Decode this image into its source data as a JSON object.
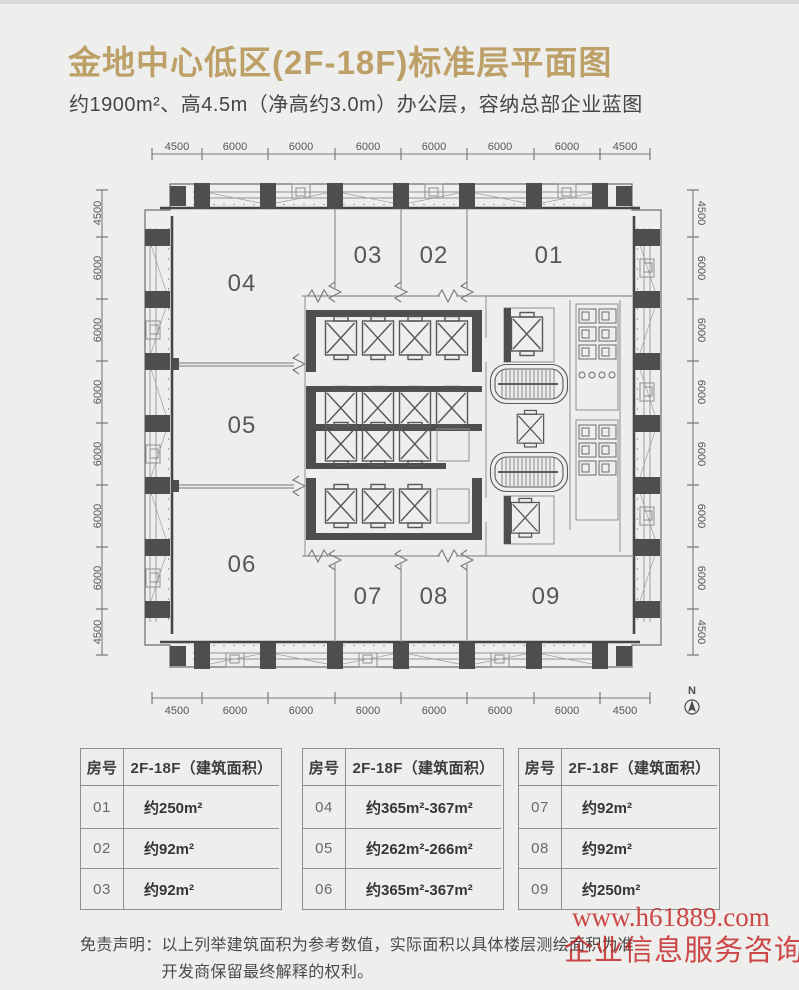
{
  "header": {
    "title": "金地中心低区(2F-18F)标准层平面图",
    "subtitle": "约1900m²、高4.5m（净高约3.0m）办公层，容纳总部企业蓝图"
  },
  "plan": {
    "dims_top": [
      "4500",
      "6000",
      "6000",
      "6000",
      "6000",
      "6000",
      "6000",
      "4500"
    ],
    "dims_bottom": [
      "4500",
      "6000",
      "6000",
      "6000",
      "6000",
      "6000",
      "6000",
      "4500"
    ],
    "dims_left": [
      "4500",
      "6000",
      "6000",
      "6000",
      "6000",
      "6000",
      "6000",
      "4500"
    ],
    "dims_right": [
      "4500",
      "6000",
      "6000",
      "6000",
      "6000",
      "6000",
      "6000",
      "4500"
    ],
    "room_labels": [
      "01",
      "02",
      "03",
      "04",
      "05",
      "06",
      "07",
      "08",
      "09"
    ],
    "north_label": "N"
  },
  "tables": [
    {
      "headers": [
        "房号",
        "2F-18F（建筑面积）"
      ],
      "rows": [
        {
          "no": "01",
          "area": "约250m²"
        },
        {
          "no": "02",
          "area": "约92m²"
        },
        {
          "no": "03",
          "area": "约92m²"
        }
      ]
    },
    {
      "headers": [
        "房号",
        "2F-18F（建筑面积）"
      ],
      "rows": [
        {
          "no": "04",
          "area": "约365m²-367m²"
        },
        {
          "no": "05",
          "area": "约262m²-266m²"
        },
        {
          "no": "06",
          "area": "约365m²-367m²"
        }
      ]
    },
    {
      "headers": [
        "房号",
        "2F-18F（建筑面积）"
      ],
      "rows": [
        {
          "no": "07",
          "area": "约92m²"
        },
        {
          "no": "08",
          "area": "约92m²"
        },
        {
          "no": "09",
          "area": "约250m²"
        }
      ]
    }
  ],
  "disclaimer": {
    "label": "免责声明：",
    "line1": "以上列举建筑面积为参考数值，实际面积以具体楼层测绘面积为准",
    "line2": "开发商保留最终解释的权利。"
  },
  "watermark": {
    "line1": "www.h61889.com",
    "line2": "企业信息服务咨询"
  },
  "colors": {
    "accent_gold": "#bda068",
    "watermark_red": "#c52222",
    "plan_dark": "#4e4e4e"
  }
}
